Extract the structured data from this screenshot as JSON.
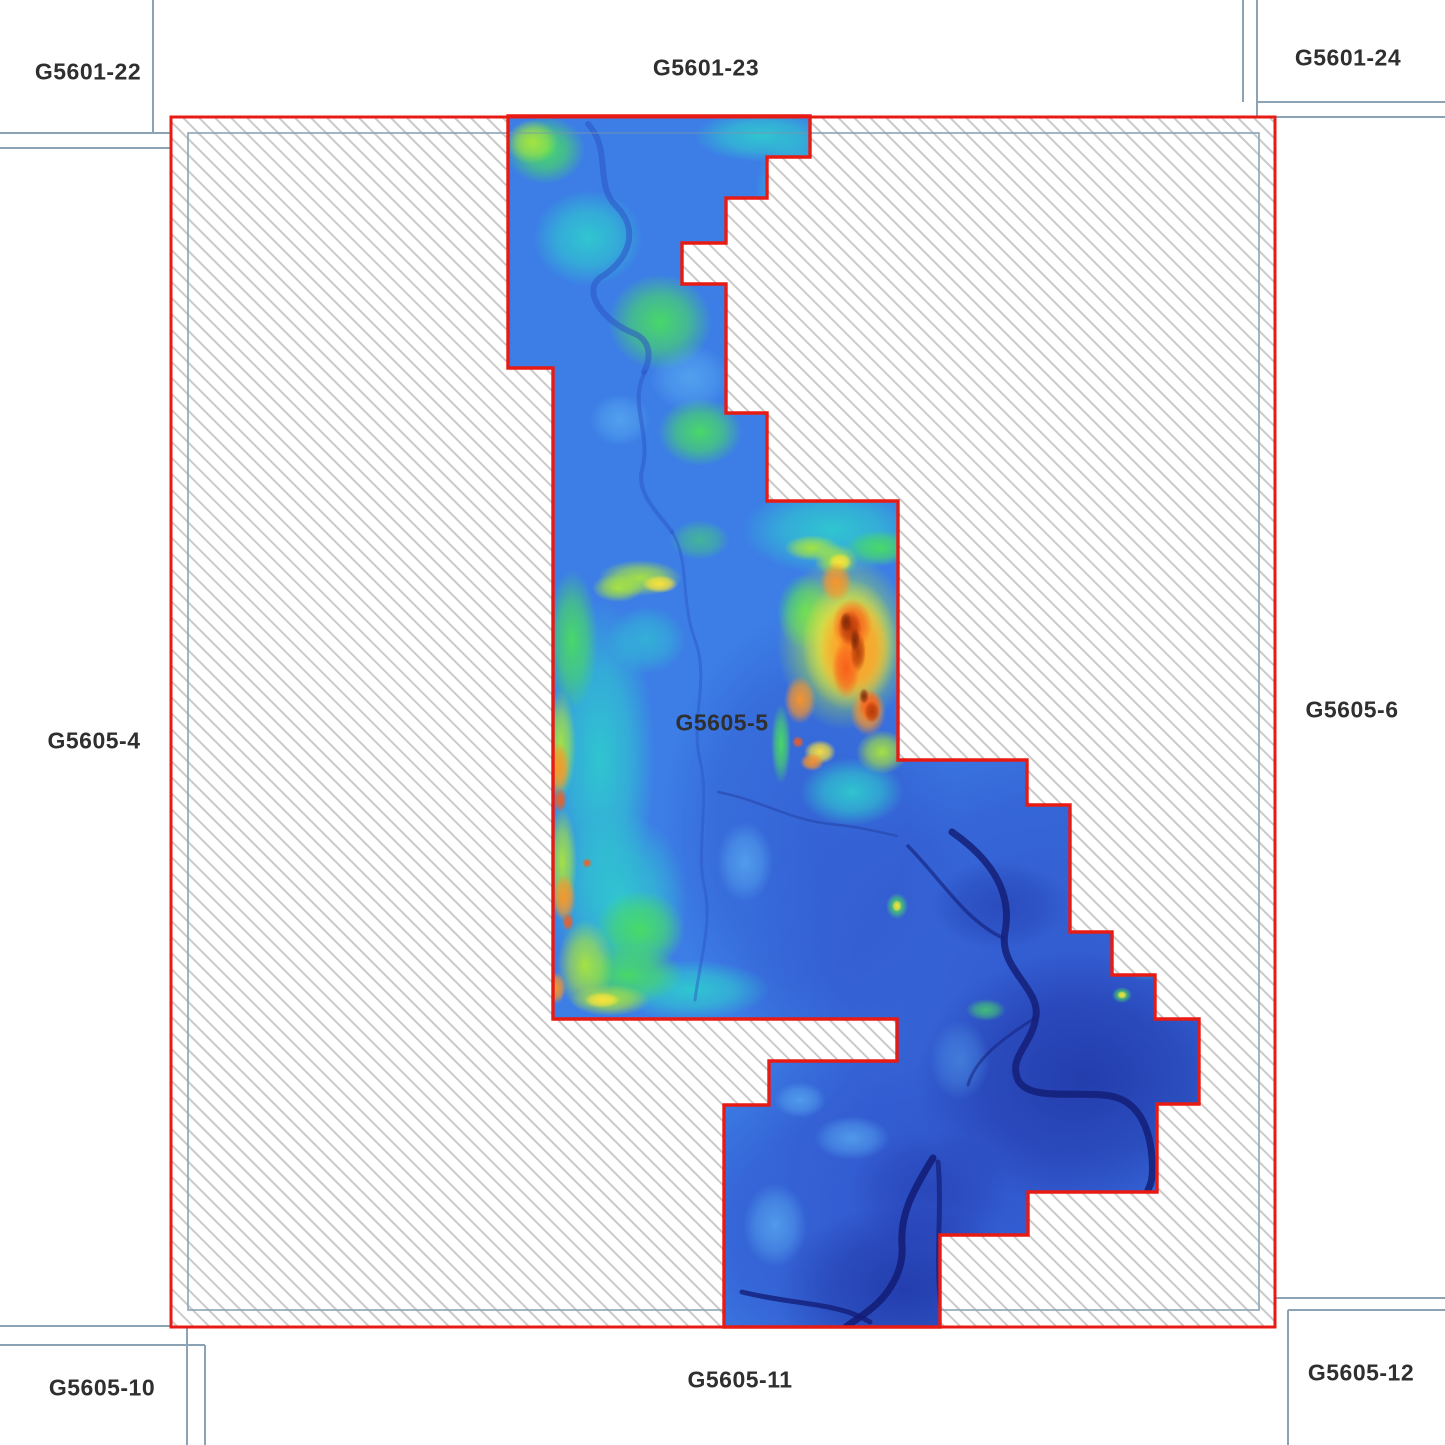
{
  "map": {
    "highlighted_tile": "G5605-5",
    "tiles": [
      {
        "id": "G5601-22",
        "label": "G5601-22",
        "position": "top-left"
      },
      {
        "id": "G5601-23",
        "label": "G5601-23",
        "position": "top-center"
      },
      {
        "id": "G5601-24",
        "label": "G5601-24",
        "position": "top-right"
      },
      {
        "id": "G5605-4",
        "label": "G5605-4",
        "position": "middle-left"
      },
      {
        "id": "G5605-5",
        "label": "G5605-5",
        "position": "center-highlighted"
      },
      {
        "id": "G5605-6",
        "label": "G5605-6",
        "position": "middle-right"
      },
      {
        "id": "G5605-10",
        "label": "G5605-10",
        "position": "bottom-left"
      },
      {
        "id": "G5605-11",
        "label": "G5605-11",
        "position": "bottom-center"
      },
      {
        "id": "G5605-12",
        "label": "G5605-12",
        "position": "bottom-right"
      }
    ],
    "colors": {
      "selection_border": "#e81b14",
      "grid_line": "#8ba3b5",
      "hatch_line": "#cacaca",
      "label_text": "#2f2f2f",
      "background": "#ffffff",
      "elevation_low": "#1d2f9e",
      "elevation_mid": "#3c7ee6",
      "elevation_high": "#b33708"
    }
  }
}
